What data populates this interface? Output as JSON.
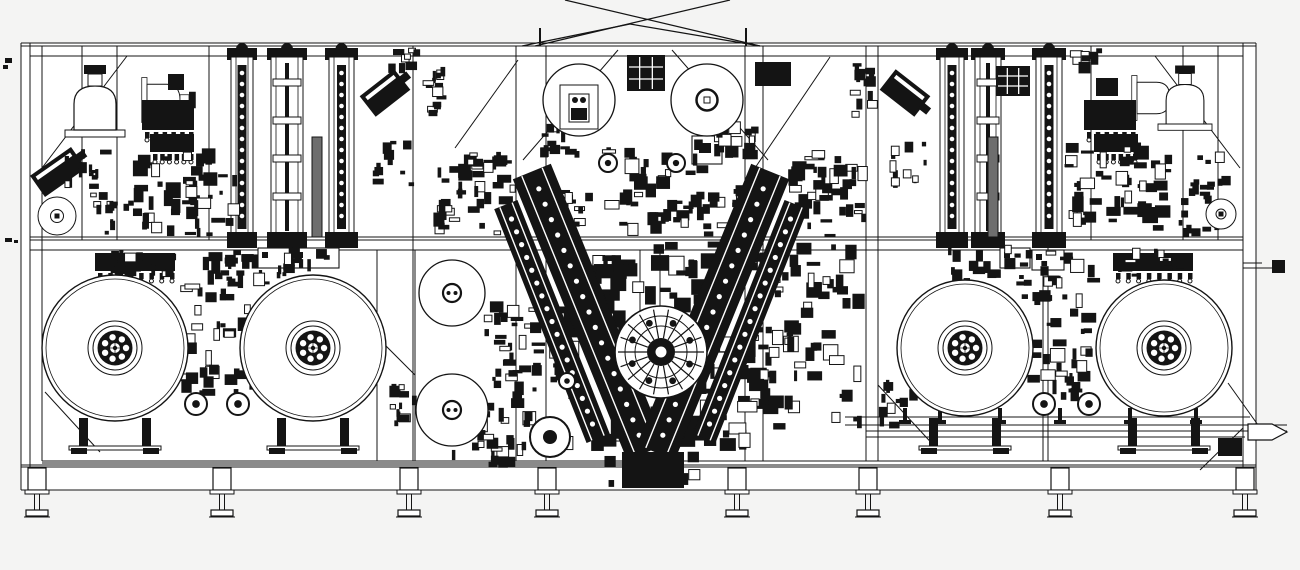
{
  "meta": {
    "description": "Black and white CAD side-elevation line drawing of an industrial reel-to-reel winding machine with four large unwind reels, two upper reels, V-shaped lamination arms over an indexing turret, vertical rail columns, bell domes and a framed base on eight leveling feet",
    "drawing_type": "engineering-line-drawing",
    "text_labels": []
  },
  "drawing": {
    "palette": {
      "ink": "#141414",
      "paper": "#ffffff",
      "bg": "#f4f4f3",
      "hatch": "#6e6e6e"
    },
    "canvas": {
      "w": 1300,
      "h": 570
    },
    "frame": {
      "paper": [
        21,
        43,
        1235,
        427
      ],
      "hlines": [
        [
          21,
          43,
          1256,
          43
        ],
        [
          21,
          46,
          1256,
          46
        ],
        [
          30,
          56,
          1243,
          56
        ],
        [
          30,
          237,
          1243,
          237
        ],
        [
          30,
          240,
          1243,
          240
        ],
        [
          30,
          250,
          1243,
          250
        ],
        [
          42,
          461,
          1243,
          461
        ],
        [
          21,
          465,
          1256,
          465
        ],
        [
          21,
          467,
          1256,
          467
        ],
        [
          21,
          490,
          1256,
          490
        ],
        [
          42,
          463,
          640,
          463
        ]
      ],
      "vposts_full": [
        21,
        30,
        42,
        413,
        516,
        546,
        745,
        763,
        866,
        878,
        1048,
        1243,
        1256
      ],
      "vposts_top": [
        82,
        117,
        209,
        1091,
        1183,
        1218
      ],
      "vposts_bottom": [
        377,
        415,
        640,
        660,
        1043
      ],
      "braces": [
        [
          42,
          168,
          127,
          56
        ],
        [
          455,
          148,
          518,
          60
        ],
        [
          755,
          168,
          830,
          57
        ],
        [
          1155,
          56,
          1240,
          168
        ],
        [
          523,
          160,
          618,
          50
        ],
        [
          768,
          160,
          672,
          50
        ],
        [
          45,
          392,
          100,
          452
        ],
        [
          375,
          335,
          415,
          375
        ],
        [
          878,
          385,
          938,
          450
        ],
        [
          1228,
          383,
          1258,
          425
        ],
        [
          1243,
          428,
          1200,
          470
        ]
      ],
      "xbrace": [
        [
          535,
          46,
          730,
          0
        ],
        [
          760,
          46,
          565,
          0
        ],
        [
          522,
          46,
          630,
          24
        ],
        [
          630,
          24,
          760,
          46
        ]
      ],
      "ticks": [
        [
          540,
          28,
          540,
          46
        ],
        [
          746,
          28,
          746,
          46
        ]
      ]
    },
    "legs": {
      "xs": [
        37,
        222,
        409,
        547,
        737,
        868,
        1060,
        1245
      ],
      "block_y": 468,
      "pad_y": 510
    },
    "reels": {
      "large": [
        {
          "cx": 115,
          "cy": 348,
          "r": 73
        },
        {
          "cx": 313,
          "cy": 348,
          "r": 73
        },
        {
          "cx": 965,
          "cy": 348,
          "r": 68
        },
        {
          "cx": 1164,
          "cy": 348,
          "r": 68
        }
      ],
      "top_left": {
        "cx": 579,
        "cy": 100,
        "r": 36
      },
      "top_right": {
        "cx": 707,
        "cy": 100,
        "r": 36
      },
      "medium": [
        {
          "cx": 452,
          "cy": 293,
          "r": 33
        },
        {
          "cx": 452,
          "cy": 410,
          "r": 36
        }
      ],
      "small_rings": [
        {
          "cx": 57,
          "cy": 216,
          "r": 19,
          "r2": 6.5
        },
        {
          "cx": 1221,
          "cy": 214,
          "r": 15,
          "r2": 5
        }
      ]
    },
    "stands": {
      "xs": [
        115,
        313,
        965,
        1164
      ]
    },
    "columns": {
      "y": 57,
      "h": 180,
      "left": [
        {
          "x": 231,
          "w": 22,
          "style": "chain"
        },
        {
          "x": 271,
          "w": 32,
          "style": "plain"
        },
        {
          "x": 312,
          "w": 10,
          "style": "hatch"
        },
        {
          "x": 329,
          "w": 25,
          "style": "chain"
        }
      ],
      "right": [
        {
          "x": 940,
          "w": 24,
          "style": "chain"
        },
        {
          "x": 975,
          "w": 26,
          "style": "plain"
        },
        {
          "x": 988,
          "w": 10,
          "style": "hatch"
        },
        {
          "x": 1036,
          "w": 26,
          "style": "chain"
        }
      ]
    },
    "domes": [
      {
        "cx": 95,
        "base": 130,
        "s": 1.0,
        "rot": 0
      },
      {
        "cx": 147,
        "base": 100,
        "s": 0.75,
        "rot": 90
      },
      {
        "cx": 1137,
        "base": 98,
        "s": 0.75,
        "rot": 90
      },
      {
        "cx": 1185,
        "base": 124,
        "s": 0.9,
        "rot": 0
      }
    ],
    "combs": [
      [
        142,
        100,
        52,
        30,
        6
      ],
      [
        150,
        134,
        44,
        18,
        6
      ],
      [
        1084,
        100,
        52,
        30,
        6
      ],
      [
        1094,
        134,
        44,
        18,
        6
      ],
      [
        95,
        253,
        80,
        18,
        8
      ],
      [
        1113,
        253,
        80,
        18,
        8
      ]
    ],
    "white_boxes": [
      [
        258,
        248,
        34,
        20
      ],
      [
        293,
        248,
        46,
        20
      ],
      [
        1000,
        248,
        30,
        20
      ],
      [
        1032,
        250,
        32,
        20
      ],
      [
        560,
        85,
        38,
        44
      ],
      [
        569,
        94,
        20,
        28
      ],
      [
        692,
        136,
        30,
        28
      ]
    ],
    "ink_boxes": [
      [
        755,
        62,
        36,
        24
      ],
      [
        622,
        452,
        62,
        36
      ],
      [
        1218,
        438,
        24,
        18
      ],
      [
        1096,
        78,
        22,
        18
      ],
      [
        168,
        74,
        16,
        16
      ],
      [
        571,
        108,
        16,
        12
      ],
      [
        699,
        143,
        12,
        10
      ]
    ],
    "grid_boxes": [
      [
        627,
        55,
        38,
        36
      ],
      [
        996,
        66,
        34,
        30
      ]
    ],
    "tilted": [
      {
        "cx": 385,
        "cy": 93,
        "w": 44,
        "h": 26,
        "a": -38
      },
      {
        "cx": 905,
        "cy": 93,
        "w": 44,
        "h": 26,
        "a": 38
      },
      {
        "cx": 58,
        "cy": 172,
        "w": 50,
        "h": 26,
        "a": -35
      }
    ],
    "varms": [
      {
        "x1": 532,
        "y1": 172,
        "x2": 646,
        "y2": 452,
        "w": 40,
        "dots": true
      },
      {
        "x1": 506,
        "y1": 205,
        "x2": 598,
        "y2": 438,
        "w": 24,
        "dots": true
      },
      {
        "x1": 770,
        "y1": 172,
        "x2": 656,
        "y2": 452,
        "w": 40,
        "dots": true
      },
      {
        "x1": 796,
        "y1": 205,
        "x2": 704,
        "y2": 438,
        "w": 24,
        "dots": true
      }
    ],
    "turret": {
      "cx": 661,
      "cy": 352,
      "r": 46,
      "spokes": 18
    },
    "rollers": [
      [
        196,
        404,
        11
      ],
      [
        238,
        404,
        11
      ],
      [
        1044,
        404,
        11
      ],
      [
        1089,
        404,
        11
      ],
      [
        550,
        437,
        20
      ],
      [
        567,
        381,
        8
      ],
      [
        608,
        163,
        9
      ],
      [
        676,
        163,
        9
      ]
    ],
    "conveyor": {
      "lines": [
        [
          845,
          417,
          1250,
          417
        ],
        [
          845,
          425,
          1287,
          425
        ],
        [
          866,
          431,
          1287,
          431
        ],
        [
          866,
          437,
          1245,
          437
        ]
      ],
      "ticks": [
        905,
        940,
        1000,
        1060,
        1130,
        1196
      ],
      "nozzle": [
        [
          1248,
          424
        ],
        [
          1272,
          424
        ],
        [
          1287,
          432
        ],
        [
          1272,
          440
        ],
        [
          1248,
          440
        ]
      ]
    },
    "rod": {
      "lines": [
        [
          1243,
          263,
          1262,
          263
        ],
        [
          1243,
          268,
          1276,
          268
        ]
      ],
      "square": [
        1272,
        260,
        13,
        13
      ]
    },
    "marks": [
      [
        5,
        58,
        7,
        5
      ],
      [
        3,
        65,
        5,
        4
      ],
      [
        5,
        238,
        7,
        4
      ],
      [
        14,
        240,
        4,
        3
      ]
    ],
    "clusters": [
      {
        "x": 128,
        "y": 148,
        "w": 112,
        "h": 90,
        "n": 50,
        "s": [
          3,
          16
        ],
        "seed": 11
      },
      {
        "x": 62,
        "y": 142,
        "w": 55,
        "h": 58,
        "n": 16,
        "s": [
          3,
          12
        ],
        "seed": 12
      },
      {
        "x": 90,
        "y": 200,
        "w": 60,
        "h": 38,
        "n": 12,
        "s": [
          3,
          10
        ],
        "seed": 13
      },
      {
        "x": 388,
        "y": 48,
        "w": 34,
        "h": 26,
        "n": 8,
        "s": [
          4,
          12
        ],
        "seed": 14
      },
      {
        "x": 372,
        "y": 140,
        "w": 44,
        "h": 48,
        "n": 12,
        "s": [
          3,
          12
        ],
        "seed": 15
      },
      {
        "x": 420,
        "y": 62,
        "w": 28,
        "h": 58,
        "n": 14,
        "s": [
          3,
          11
        ],
        "seed": 16
      },
      {
        "x": 432,
        "y": 150,
        "w": 86,
        "h": 88,
        "n": 40,
        "s": [
          3,
          15
        ],
        "seed": 17
      },
      {
        "x": 95,
        "y": 248,
        "w": 85,
        "h": 30,
        "n": 18,
        "s": [
          3,
          12
        ],
        "seed": 18
      },
      {
        "x": 225,
        "y": 245,
        "w": 118,
        "h": 42,
        "n": 26,
        "s": [
          3,
          13
        ],
        "seed": 19
      },
      {
        "x": 380,
        "y": 378,
        "w": 42,
        "h": 52,
        "n": 12,
        "s": [
          3,
          12
        ],
        "seed": 20
      },
      {
        "x": 600,
        "y": 138,
        "w": 112,
        "h": 100,
        "n": 45,
        "s": [
          3,
          15
        ],
        "seed": 21
      },
      {
        "x": 548,
        "y": 188,
        "w": 50,
        "h": 48,
        "n": 15,
        "s": [
          3,
          12
        ],
        "seed": 22
      },
      {
        "x": 700,
        "y": 185,
        "w": 55,
        "h": 52,
        "n": 15,
        "s": [
          3,
          12
        ],
        "seed": 23
      },
      {
        "x": 548,
        "y": 238,
        "w": 226,
        "h": 215,
        "n": 175,
        "s": [
          4,
          20
        ],
        "seed": 24
      },
      {
        "x": 480,
        "y": 300,
        "w": 66,
        "h": 135,
        "n": 45,
        "s": [
          3,
          14
        ],
        "seed": 25
      },
      {
        "x": 433,
        "y": 430,
        "w": 95,
        "h": 38,
        "n": 22,
        "s": [
          3,
          13
        ],
        "seed": 26
      },
      {
        "x": 756,
        "y": 240,
        "w": 112,
        "h": 190,
        "n": 70,
        "s": [
          3,
          16
        ],
        "seed": 27
      },
      {
        "x": 600,
        "y": 450,
        "w": 110,
        "h": 38,
        "n": 22,
        "s": [
          3,
          12
        ],
        "seed": 28
      },
      {
        "x": 538,
        "y": 116,
        "w": 46,
        "h": 44,
        "n": 18,
        "s": [
          3,
          13
        ],
        "seed": 29
      },
      {
        "x": 714,
        "y": 116,
        "w": 46,
        "h": 44,
        "n": 18,
        "s": [
          3,
          13
        ],
        "seed": 30
      },
      {
        "x": 1062,
        "y": 142,
        "w": 112,
        "h": 90,
        "n": 50,
        "s": [
          3,
          16
        ],
        "seed": 31
      },
      {
        "x": 1180,
        "y": 150,
        "w": 55,
        "h": 50,
        "n": 14,
        "s": [
          3,
          12
        ],
        "seed": 32
      },
      {
        "x": 1175,
        "y": 195,
        "w": 55,
        "h": 45,
        "n": 12,
        "s": [
          3,
          10
        ],
        "seed": 33
      },
      {
        "x": 1070,
        "y": 48,
        "w": 34,
        "h": 26,
        "n": 8,
        "s": [
          4,
          12
        ],
        "seed": 34
      },
      {
        "x": 884,
        "y": 140,
        "w": 44,
        "h": 48,
        "n": 12,
        "s": [
          3,
          12
        ],
        "seed": 35
      },
      {
        "x": 850,
        "y": 62,
        "w": 28,
        "h": 58,
        "n": 14,
        "s": [
          3,
          11
        ],
        "seed": 36
      },
      {
        "x": 782,
        "y": 150,
        "w": 86,
        "h": 88,
        "n": 40,
        "s": [
          3,
          15
        ],
        "seed": 37
      },
      {
        "x": 945,
        "y": 245,
        "w": 118,
        "h": 42,
        "n": 26,
        "s": [
          3,
          13
        ],
        "seed": 38
      },
      {
        "x": 1110,
        "y": 248,
        "w": 85,
        "h": 30,
        "n": 18,
        "s": [
          3,
          12
        ],
        "seed": 39
      },
      {
        "x": 878,
        "y": 378,
        "w": 42,
        "h": 52,
        "n": 12,
        "s": [
          3,
          12
        ],
        "seed": 40
      },
      {
        "x": 178,
        "y": 252,
        "w": 84,
        "h": 150,
        "n": 48,
        "s": [
          3,
          15
        ],
        "seed": 41
      },
      {
        "x": 1018,
        "y": 252,
        "w": 84,
        "h": 150,
        "n": 48,
        "s": [
          3,
          15
        ],
        "seed": 42
      }
    ]
  }
}
